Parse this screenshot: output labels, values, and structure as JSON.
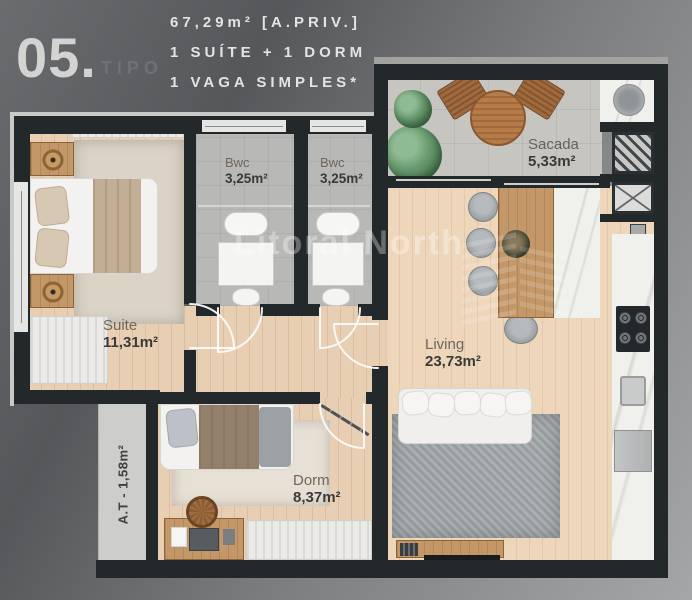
{
  "header": {
    "unit_number": "05.",
    "unit_type": "TIPO",
    "area_line": "67,29m² [A.PRIV.]",
    "program_line": "1 SUÍTE + 1 DORM",
    "parking_line": "1 VAGA SIMPLES*"
  },
  "rooms": {
    "suite": {
      "name": "Suite",
      "area": "11,31m²"
    },
    "bwc1": {
      "name": "Bwc",
      "area": "3,25m²"
    },
    "bwc2": {
      "name": "Bwc",
      "area": "3,25m²"
    },
    "sacada": {
      "name": "Sacada",
      "area": "5,33m²"
    },
    "living": {
      "name": "Living",
      "area": "23,73m²"
    },
    "dorm": {
      "name": "Dorm",
      "area": "8,37m²"
    },
    "technical_area": {
      "label": "A.T - 1,58m²"
    }
  },
  "watermark": {
    "text": "Litoral North"
  },
  "colors": {
    "background_top": "#57595c",
    "background_bottom": "#a6a7a9",
    "wall": "#23282a",
    "wood_floor": "#e8ceb2",
    "balcony_tile": "#c7c5c0",
    "bathroom_tile": "#b8b8b6",
    "header_text": "#e4e4e2",
    "unit_number_text": "#d3d4d1",
    "label_area_text": "#3a3a38"
  }
}
